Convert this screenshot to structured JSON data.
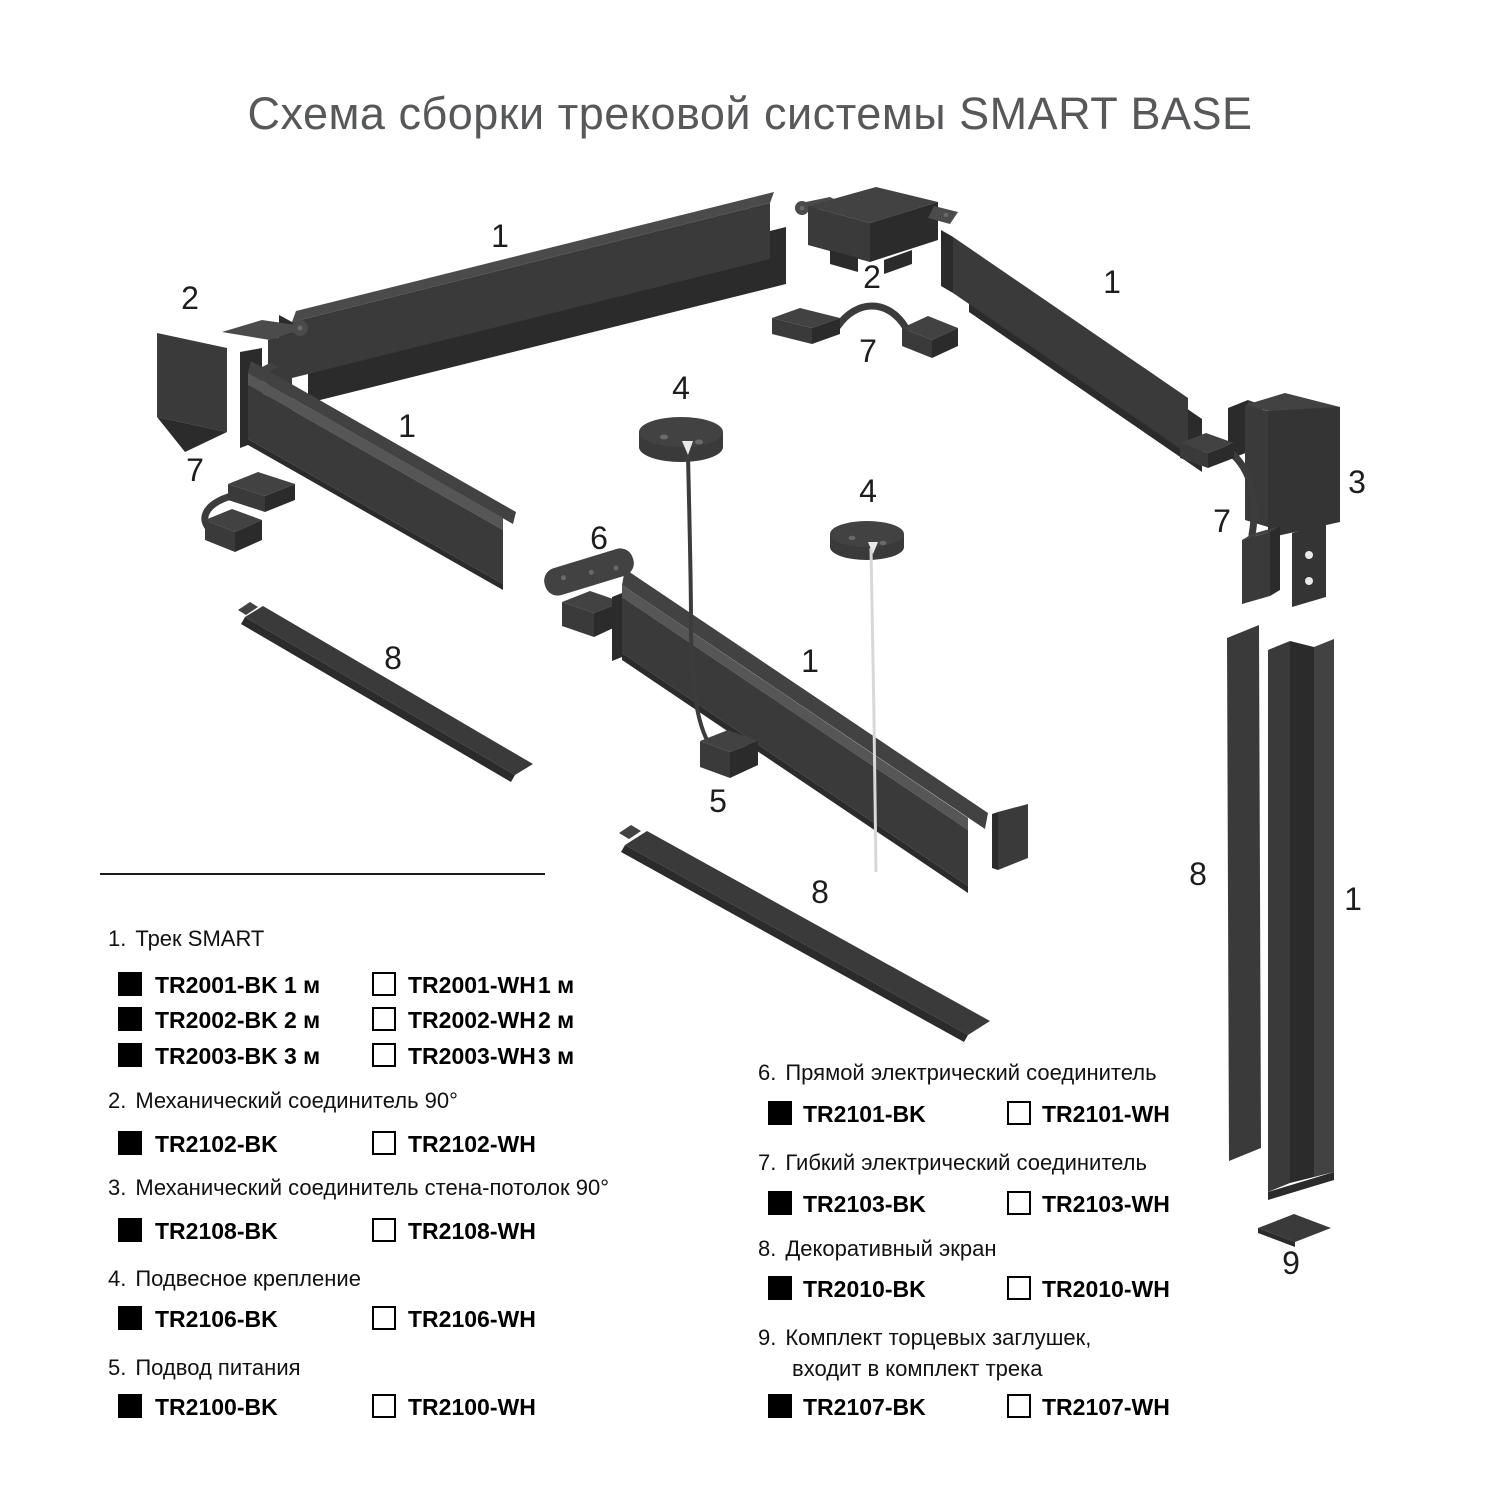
{
  "title": "Схема сборки трековой системы SMART BASE",
  "colors": {
    "part-light": "#4b4b4b",
    "part-mid": "#3a3a3a",
    "part-mid2": "#424242",
    "part-dark": "#2b2b2b",
    "wire-dark": "#3c3c3c",
    "wire-light": "#d8d8d8",
    "label": "#1d1d1d",
    "title": "#57585a",
    "text": "#111111"
  },
  "diagram": {
    "labels": [
      {
        "text": "1"
      },
      {
        "text": "2"
      },
      {
        "text": "2"
      },
      {
        "text": "7"
      },
      {
        "text": "1"
      },
      {
        "text": "1"
      },
      {
        "text": "7"
      },
      {
        "text": "4"
      },
      {
        "text": "4"
      },
      {
        "text": "6"
      },
      {
        "text": "1"
      },
      {
        "text": "8"
      },
      {
        "text": "5"
      },
      {
        "text": "8"
      },
      {
        "text": "3"
      },
      {
        "text": "7"
      },
      {
        "text": "8"
      },
      {
        "text": "1"
      },
      {
        "text": "9"
      }
    ]
  },
  "legend": {
    "items": [
      {
        "num": "1.",
        "name": "Трек SMART",
        "rows": [
          {
            "bk": "TR2001-BK",
            "bk_size": "1 м",
            "wh": "TR2001-WH",
            "wh_size": "1 м"
          },
          {
            "bk": "TR2002-BK",
            "bk_size": "2 м",
            "wh": "TR2002-WH",
            "wh_size": "2 м"
          },
          {
            "bk": "TR2003-BK",
            "bk_size": "3 м",
            "wh": "TR2003-WH",
            "wh_size": "3 м"
          }
        ]
      },
      {
        "num": "2.",
        "name": "Механический соединитель 90°",
        "rows": [
          {
            "bk": "TR2102-BK",
            "wh": "TR2102-WH"
          }
        ]
      },
      {
        "num": "3.",
        "name": "Механический соединитель стена-потолок 90°",
        "rows": [
          {
            "bk": "TR2108-BK",
            "wh": "TR2108-WH"
          }
        ]
      },
      {
        "num": "4.",
        "name": "Подвесное крепление",
        "rows": [
          {
            "bk": "TR2106-BK",
            "wh": "TR2106-WH"
          }
        ]
      },
      {
        "num": "5.",
        "name": "Подвод питания",
        "rows": [
          {
            "bk": "TR2100-BK",
            "wh": "TR2100-WH"
          }
        ]
      },
      {
        "num": "6.",
        "name": "Прямой электрический соединитель",
        "rows": [
          {
            "bk": "TR2101-BK",
            "wh": "TR2101-WH"
          }
        ]
      },
      {
        "num": "7.",
        "name": "Гибкий электрический соединитель",
        "rows": [
          {
            "bk": "TR2103-BK",
            "wh": "TR2103-WH"
          }
        ]
      },
      {
        "num": "8.",
        "name": "Декоративный экран",
        "rows": [
          {
            "bk": "TR2010-BK",
            "wh": "TR2010-WH"
          }
        ]
      },
      {
        "num": "9.",
        "name": "Комплект торцевых заглушек,",
        "name2": "входит в комплект трека",
        "rows": [
          {
            "bk": "TR2107-BK",
            "wh": "TR2107-WH"
          }
        ]
      }
    ]
  }
}
